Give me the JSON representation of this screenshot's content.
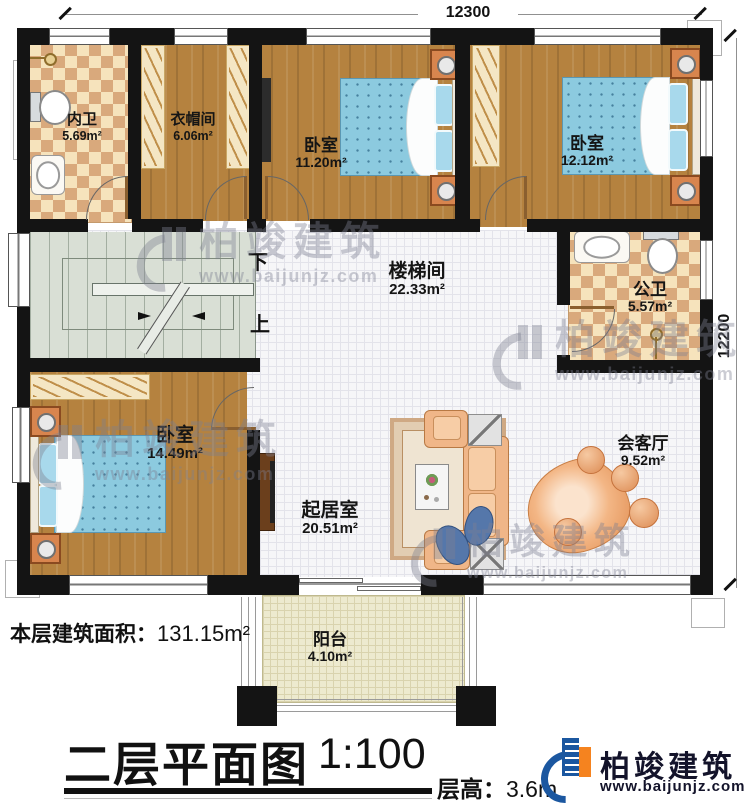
{
  "dimensions": {
    "top": "12300",
    "right": "12200"
  },
  "rooms": {
    "inner_bath": {
      "name": "内卫",
      "area": "5.69m²"
    },
    "cloakroom": {
      "name": "衣帽间",
      "area": "6.06m²"
    },
    "bedroom_top_mid": {
      "name": "卧室",
      "area": "11.20m²"
    },
    "bedroom_top_right": {
      "name": "卧室",
      "area": "12.12m²"
    },
    "public_bath": {
      "name": "公卫",
      "area": "5.57m²"
    },
    "stair_hall": {
      "name": "楼梯间",
      "area": "22.33m²"
    },
    "bedroom_bottom": {
      "name": "卧室",
      "area": "14.49m²"
    },
    "living_room": {
      "name": "起居室",
      "area": "20.51m²"
    },
    "reception": {
      "name": "会客厅",
      "area": "9.52m²"
    },
    "balcony": {
      "name": "阳台",
      "area": "4.10m²"
    }
  },
  "stairs": {
    "down_label": "下",
    "up_label": "上"
  },
  "footer": {
    "floor_area_label": "本层建筑面积：",
    "floor_area_value": "131.15m²",
    "title": "二层平面图",
    "scale": "1:100",
    "floor_height_label": "层高：",
    "floor_height_value": "3.6m"
  },
  "brand": {
    "name": "柏竣建筑",
    "website": "www.baijunjz.com"
  },
  "watermark": {
    "name": "柏竣建筑",
    "website": "www.baijunjz.com"
  },
  "colors": {
    "wall": "#141414",
    "wood": "#b5823f",
    "tile_light": "#f6e3bc",
    "tile_dark": "#d9a97c",
    "stair": "#d9dfd5",
    "bed": "#8ccadf",
    "sofa": "#f0b688",
    "brand_blue": "#1b57a0",
    "brand_orange": "#f5831f"
  }
}
